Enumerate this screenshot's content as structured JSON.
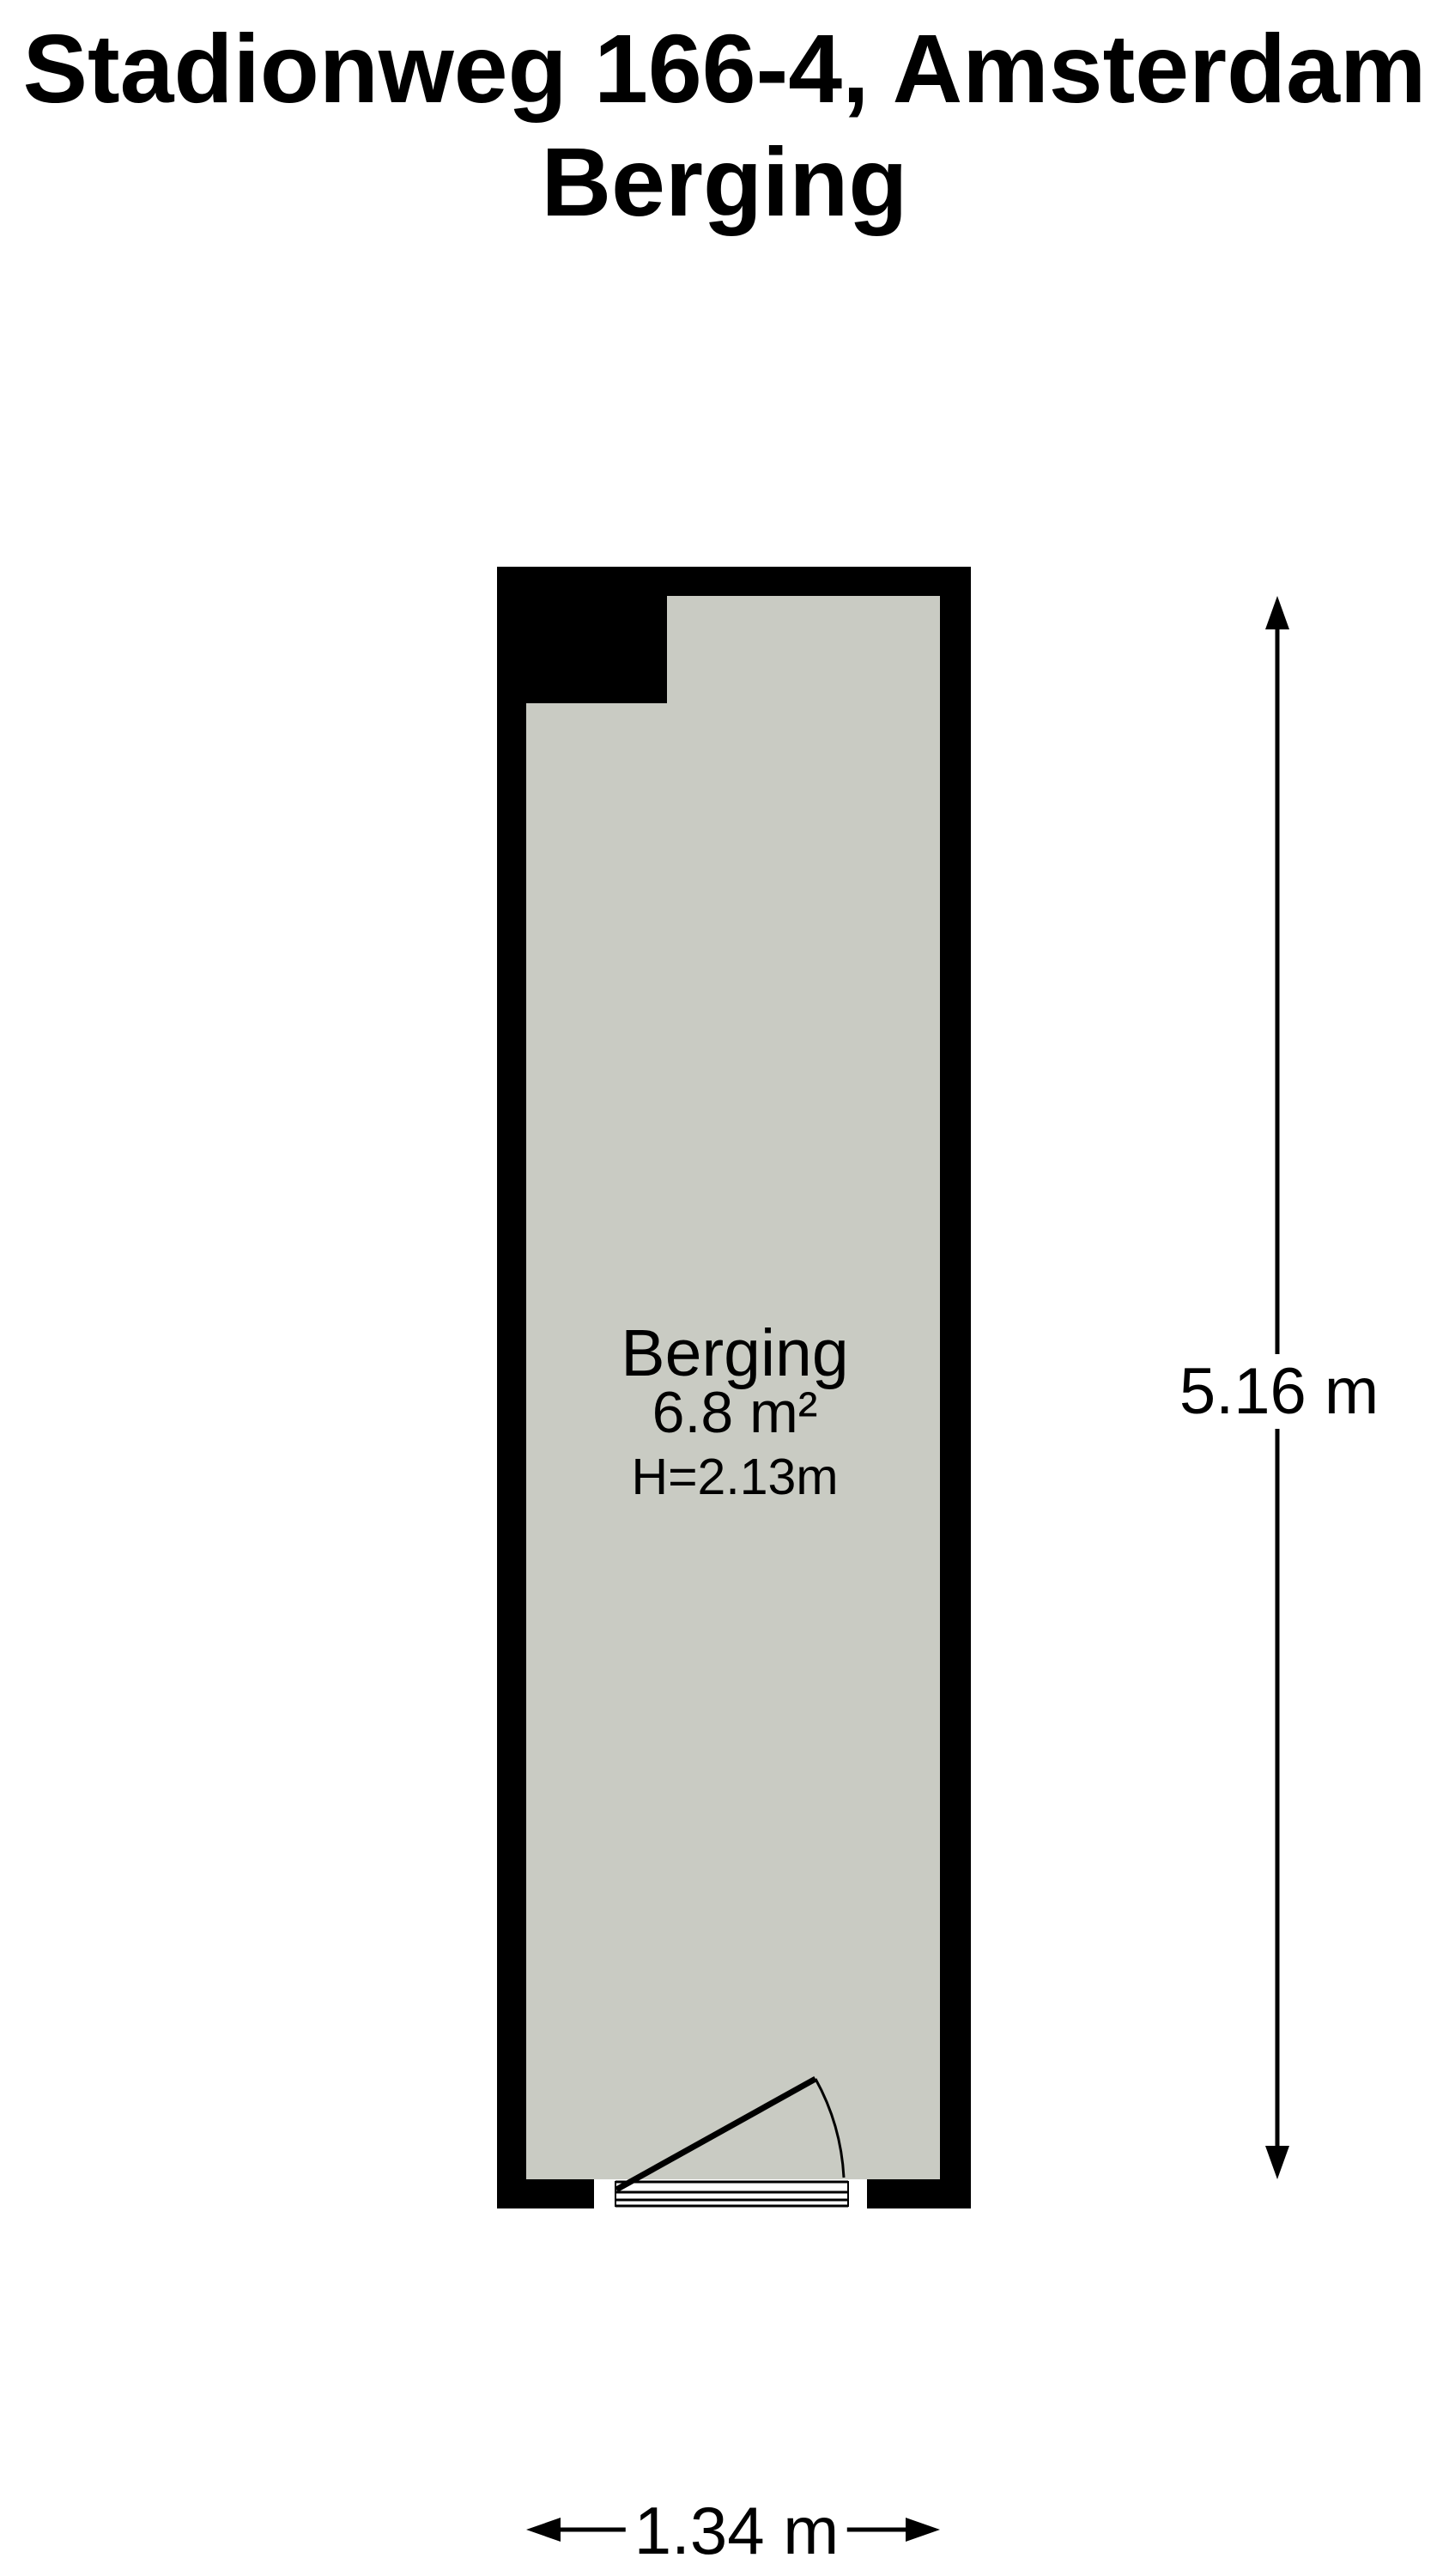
{
  "title": {
    "line1": "Stadionweg 166-4, Amsterdam",
    "line2": "Berging"
  },
  "room": {
    "name": "Berging",
    "area": "6.8 m²",
    "ceiling_height": "H=2.13m"
  },
  "dimensions": {
    "height_label": "5.16 m",
    "width_label": "1.34 m"
  },
  "colors": {
    "wall": "#000000",
    "floor": "#c9cbc3",
    "background": "#ffffff",
    "text": "#000000"
  }
}
